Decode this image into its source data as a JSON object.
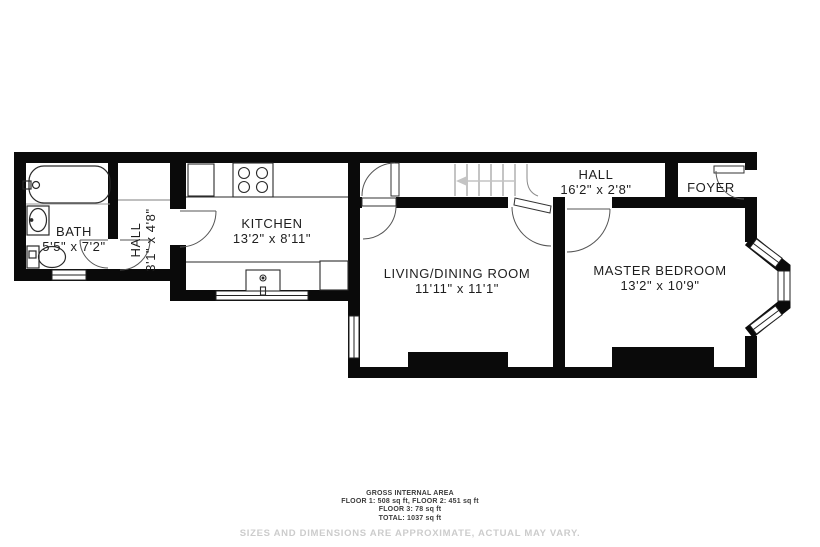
{
  "rooms": {
    "bath": {
      "name": "BATH",
      "dims": "5'5\" x 7'2\""
    },
    "hall_lower": {
      "name": "HALL",
      "dims": "3'1\" x 4'8\""
    },
    "kitchen": {
      "name": "KITCHEN",
      "dims": "13'2\" x 8'11\""
    },
    "living_dining": {
      "name": "LIVING/DINING ROOM",
      "dims": "11'11\" x 11'1\""
    },
    "hall_upper": {
      "name": "HALL",
      "dims": "16'2\" x 2'8\""
    },
    "foyer": {
      "name": "FOYER"
    },
    "master_bedroom": {
      "name": "MASTER BEDROOM",
      "dims": "13'2\" x 10'9\""
    }
  },
  "footer": {
    "area_title": "GROSS INTERNAL AREA",
    "area_line1": "FLOOR 1: 508 sq ft, FLOOR 2: 451 sq ft",
    "area_line2": "FLOOR 3: 78 sq ft",
    "area_line3": "TOTAL: 1037 sq ft",
    "disclaimer": "SIZES AND DIMENSIONS ARE APPROXIMATE, ACTUAL MAY VARY."
  },
  "colors": {
    "wall": "#0a0a0a",
    "label_text": "#1e1e1e",
    "footer_text": "#3c3c3c",
    "disclaimer_text": "#cccccc"
  }
}
